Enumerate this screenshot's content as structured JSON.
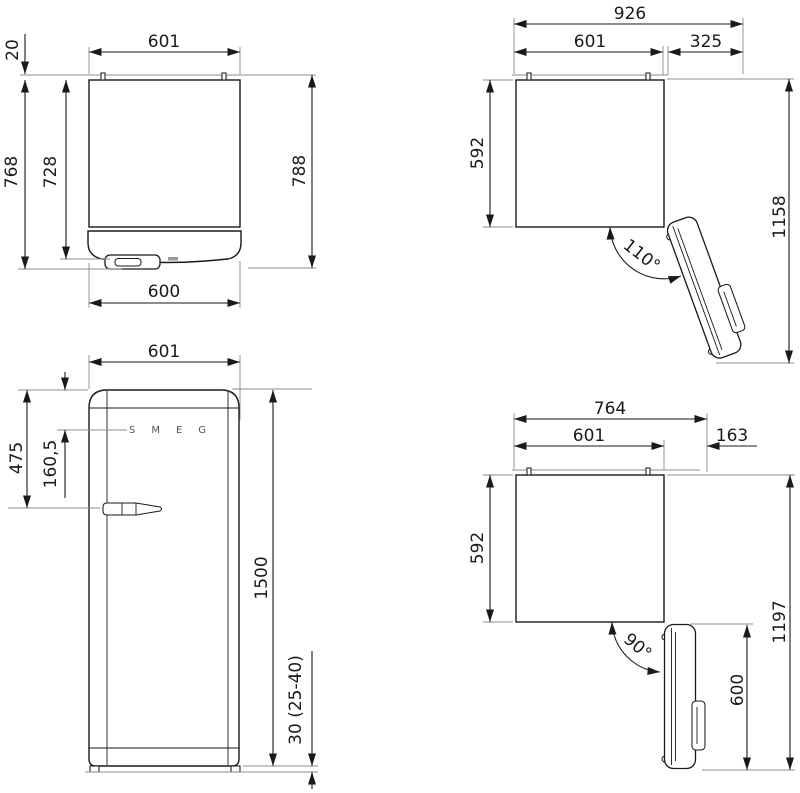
{
  "drawing": {
    "type": "refrigerator-installation-dimension-drawing",
    "units": "mm",
    "views": {
      "top_closed": {
        "width_top": "601",
        "rear_gap": "20",
        "depth_body": "728",
        "depth_no_wall": "768",
        "depth_total": "788",
        "door_width": "600"
      },
      "top_open_110": {
        "overall_width": "926",
        "body_width": "601",
        "door_swing": "325",
        "body_depth": "592",
        "overall_depth": "1158",
        "angle": "110°"
      },
      "front": {
        "width": "601",
        "top_to_handle": "475",
        "top_to_logo": "160,5",
        "height": "1500",
        "plinth": "30 (25-40)",
        "logo": "SMEG"
      },
      "top_open_90": {
        "overall_width": "764",
        "body_width": "601",
        "door_offset": "163",
        "body_depth": "592",
        "overall_depth": "1197",
        "door_width": "600",
        "angle": "90°"
      }
    },
    "colors": {
      "line": "#1a1a1a",
      "extension_line": "#8c8c8c",
      "background": "#ffffff",
      "logo_gray": "#555555"
    }
  }
}
